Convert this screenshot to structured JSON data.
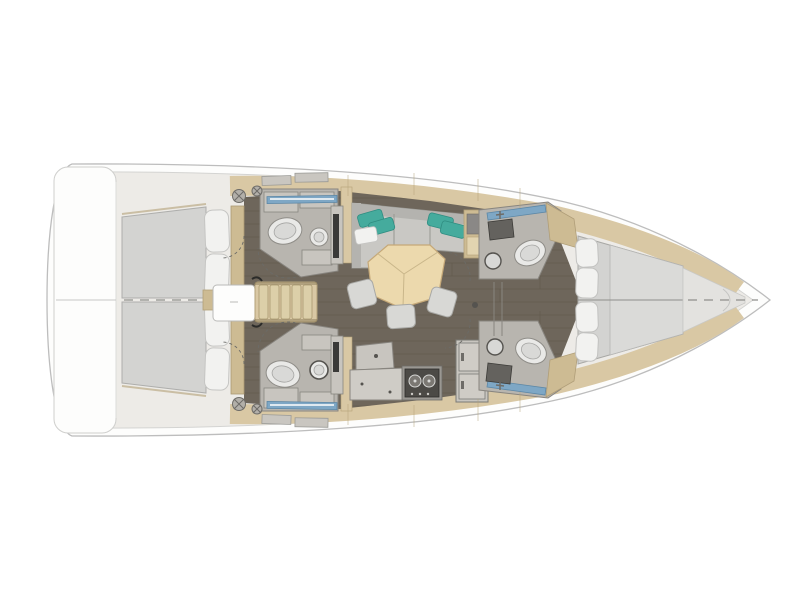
{
  "diagram": {
    "type": "yacht-floor-plan",
    "orientation": "bow-right",
    "rooms": [
      {
        "id": "stern-platform",
        "label": "Stern swim platform"
      },
      {
        "id": "aft-cabin-port",
        "label": "Aft double cabin (port)"
      },
      {
        "id": "aft-cabin-starboard",
        "label": "Aft double cabin (starboard)"
      },
      {
        "id": "companionway",
        "label": "Companionway steps with engine box"
      },
      {
        "id": "head-aft-port",
        "label": "Aft head / shower (port)"
      },
      {
        "id": "head-aft-starboard",
        "label": "Aft head / shower (starboard)"
      },
      {
        "id": "salon",
        "label": "Salon with L-sofa and pentagon table"
      },
      {
        "id": "galley",
        "label": "Galley with stove and refrigerator"
      },
      {
        "id": "head-forward-port",
        "label": "Forward head (port)"
      },
      {
        "id": "head-forward-starboard",
        "label": "Forward head (starboard)"
      },
      {
        "id": "forward-cabin",
        "label": "Forward V-berth cabin"
      },
      {
        "id": "bow",
        "label": "Bow with anchor locker"
      }
    ],
    "features": [
      {
        "id": "toilet",
        "count": 4
      },
      {
        "id": "washbasin",
        "count": 4
      },
      {
        "id": "dining-stool",
        "count": 3
      },
      {
        "id": "teal-pillow",
        "count": 4
      },
      {
        "id": "stove-burner",
        "count": 2
      },
      {
        "id": "winch",
        "count": 4
      }
    ]
  },
  "colors": {
    "bg": "#ffffff",
    "hullStroke": "#bdbdbd",
    "innerStroke": "#d4d4d2",
    "deckPale": "#edebe7",
    "trimTan": "#d9c8a4",
    "trimTanDark": "#cdbb93",
    "trimStroke": "#b3a178",
    "floor": "#6e665b",
    "floorSeam": "#57503f",
    "roomFloor": "#b8b5af",
    "roomStroke": "#88857f",
    "cabinet": "#c8c5bf",
    "cabinetLight": "#cfccc6",
    "fixtureWhite": "#e9e9e7",
    "fixtureStroke": "#8f8d88",
    "sinkDark": "#64625e",
    "mattress": "#d3d3d1",
    "mattressLight": "#dadad8",
    "mattressStroke": "#a9a9a7",
    "pillow": "#f2f2f0",
    "pillowStroke": "#c5c5c3",
    "sofa": "#c9c8c4",
    "sofaBack": "#b4b3af",
    "armrest": "#bfbeba",
    "tealPillow": "#45ab9d",
    "tealStroke": "#2f8d81",
    "table": "#ecd9ad",
    "tableStroke": "#c5a878",
    "stool": "#d8d8d5",
    "stairTread": "#dccfa9",
    "stoveRim": "#9a9792",
    "stove": "#4c4a46",
    "burner": "#7b7873",
    "windowBlue": "#7ea7c5",
    "windowBlueStroke": "#5c87a6",
    "tv": "#3a3a38",
    "white": "#fdfdfc",
    "panelDark": "#8a8886",
    "panelTan": "#e2d4b0",
    "hardware": "#b2afa9"
  }
}
